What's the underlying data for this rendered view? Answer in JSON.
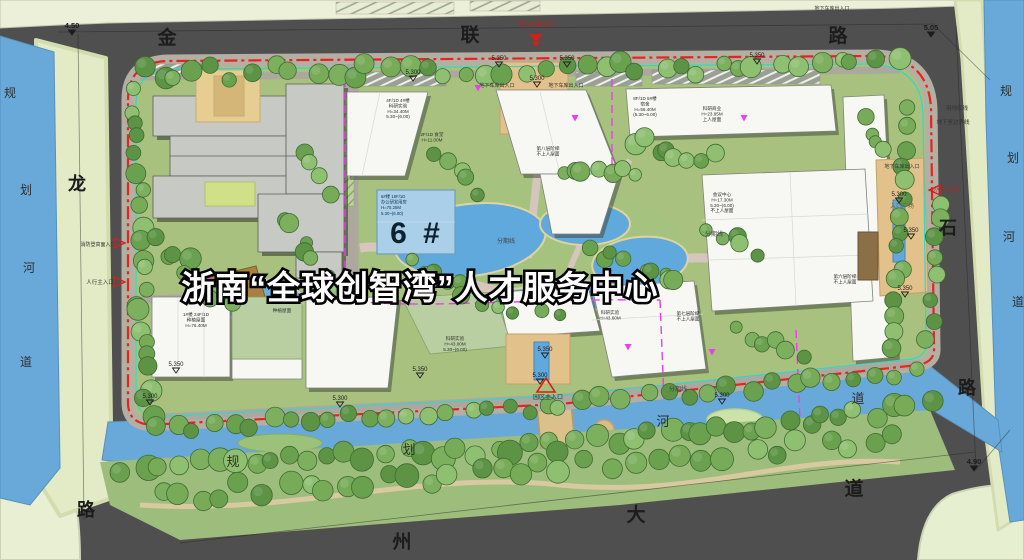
{
  "banner": {
    "title": "浙南“全球创智湾”人才服务中心"
  },
  "highlight_building": {
    "big_label": "6 #",
    "lines": [
      "6#楼 18F/1D",
      "办公研发用房",
      "H=75.25M",
      "5.30~(6.00)"
    ]
  },
  "map_labels": [
    {
      "text": "金",
      "x": 167,
      "y": 44,
      "size": 19,
      "color": "#1c1c1c",
      "bold": true
    },
    {
      "text": "联",
      "x": 470,
      "y": 41,
      "size": 19,
      "color": "#1c1c1c",
      "bold": true
    },
    {
      "text": "路",
      "x": 838,
      "y": 42,
      "size": 19,
      "color": "#1c1c1c",
      "bold": true
    },
    {
      "text": "龙",
      "x": 77,
      "y": 190,
      "size": 18,
      "color": "#1c1c1c",
      "bold": true
    },
    {
      "text": "路",
      "x": 86,
      "y": 516,
      "size": 18,
      "color": "#1c1c1c",
      "bold": true
    },
    {
      "text": "石",
      "x": 948,
      "y": 234,
      "size": 18,
      "color": "#1c1c1c",
      "bold": true
    },
    {
      "text": "路",
      "x": 967,
      "y": 394,
      "size": 18,
      "color": "#1c1c1c",
      "bold": true
    },
    {
      "text": "州",
      "x": 402,
      "y": 548,
      "size": 19,
      "color": "#1c1c1c",
      "bold": true
    },
    {
      "text": "大",
      "x": 636,
      "y": 521,
      "size": 19,
      "color": "#1c1c1c",
      "bold": true
    },
    {
      "text": "道",
      "x": 854,
      "y": 495,
      "size": 19,
      "color": "#1c1c1c",
      "bold": true
    },
    {
      "text": "规",
      "x": 10,
      "y": 97,
      "size": 12,
      "color": "#2f2f2f",
      "bold": false
    },
    {
      "text": "划",
      "x": 26,
      "y": 194,
      "size": 12,
      "color": "#2f2f2f",
      "bold": false
    },
    {
      "text": "河",
      "x": 29,
      "y": 272,
      "size": 12,
      "color": "#2f2f2f",
      "bold": false
    },
    {
      "text": "道",
      "x": 26,
      "y": 366,
      "size": 12,
      "color": "#2f2f2f",
      "bold": false
    },
    {
      "text": "规",
      "x": 1006,
      "y": 95,
      "size": 12,
      "color": "#2f2f2f",
      "bold": false
    },
    {
      "text": "划",
      "x": 1013,
      "y": 162,
      "size": 12,
      "color": "#2f2f2f",
      "bold": false
    },
    {
      "text": "河",
      "x": 1009,
      "y": 241,
      "size": 12,
      "color": "#2f2f2f",
      "bold": false
    },
    {
      "text": "道",
      "x": 1018,
      "y": 306,
      "size": 12,
      "color": "#2f2f2f",
      "bold": false
    },
    {
      "text": "规",
      "x": 233,
      "y": 466,
      "size": 13,
      "color": "#2f2f2f",
      "bold": false
    },
    {
      "text": "划",
      "x": 409,
      "y": 454,
      "size": 13,
      "color": "#2f2f2f",
      "bold": false
    },
    {
      "text": "河",
      "x": 663,
      "y": 426,
      "size": 13,
      "color": "#2f2f2f",
      "bold": false
    },
    {
      "text": "道",
      "x": 858,
      "y": 403,
      "size": 13,
      "color": "#2f2f2f",
      "bold": false
    }
  ],
  "annotations": [
    {
      "text": "办公主要入口",
      "x": 536,
      "y": 26,
      "size": 6,
      "color": "#c22015"
    },
    {
      "text": "地下车库出入口",
      "x": 497,
      "y": 87,
      "size": 5,
      "color": "#333333"
    },
    {
      "text": "地下车库出入口",
      "x": 566,
      "y": 87,
      "size": 5,
      "color": "#333333"
    },
    {
      "text": "地下车库出入口",
      "x": 832,
      "y": 10,
      "size": 5,
      "color": "#333333"
    },
    {
      "text": "地下车库出入口",
      "x": 902,
      "y": 168,
      "size": 5,
      "color": "#333333"
    },
    {
      "text": "用地红线",
      "x": 957,
      "y": 110,
      "size": 5.5,
      "color": "#333333"
    },
    {
      "text": "地下室边界线",
      "x": 953,
      "y": 124,
      "size": 5.5,
      "color": "#333333"
    },
    {
      "text": "分期线",
      "x": 506,
      "y": 243,
      "size": 6,
      "color": "#444444"
    },
    {
      "text": "分期线",
      "x": 714,
      "y": 236,
      "size": 6,
      "color": "#444444"
    },
    {
      "text": "分期线",
      "x": 678,
      "y": 391,
      "size": 6,
      "color": "#444444"
    },
    {
      "text": "入口广场",
      "x": 902,
      "y": 208,
      "size": 6,
      "color": "#7a5c28"
    },
    {
      "text": "园区主入口",
      "x": 548,
      "y": 399,
      "size": 6,
      "color": "#333333"
    },
    {
      "text": "办公主入口",
      "x": 947,
      "y": 191,
      "size": 5.5,
      "color": "#c22015"
    },
    {
      "text": "人行主入口",
      "x": 100,
      "y": 284,
      "size": 5.5,
      "color": "#333333"
    },
    {
      "text": "消防登高面入口",
      "x": 98,
      "y": 246,
      "size": 5,
      "color": "#333333"
    }
  ],
  "building_notes": [
    {
      "x": 398,
      "y": 102,
      "lines": [
        "4F/1D 4#楼",
        "科研实验",
        "H=34.40M",
        "5.30~(6.00)"
      ]
    },
    {
      "x": 432,
      "y": 136,
      "lines": [
        "2F/1D 食堂",
        "H=11.00M"
      ]
    },
    {
      "x": 645,
      "y": 100,
      "lines": [
        "8F/1D 5#楼",
        "宿舍",
        "H=56.40M",
        "(5.30~6.00)"
      ]
    },
    {
      "x": 548,
      "y": 150,
      "lines": [
        "第八层阶梯",
        "不上人屋面"
      ]
    },
    {
      "x": 712,
      "y": 110,
      "lines": [
        "科研商业",
        "H=23.95M",
        "上人屋面"
      ]
    },
    {
      "x": 722,
      "y": 196,
      "lines": [
        "会议中心",
        "H=17.30M",
        "5.30~(6.00)",
        "不上人屋面"
      ]
    },
    {
      "x": 845,
      "y": 278,
      "lines": [
        "第六层阶梯",
        "不上人屋面"
      ]
    },
    {
      "x": 688,
      "y": 315,
      "lines": [
        "第七层阶梯",
        "不上人屋面"
      ]
    },
    {
      "x": 196,
      "y": 316,
      "lines": [
        "1#楼 24F/1D",
        "种植屋面",
        "H=76.40M"
      ]
    },
    {
      "x": 282,
      "y": 312,
      "lines": [
        "种植屋面"
      ]
    },
    {
      "x": 455,
      "y": 340,
      "lines": [
        "科研实验",
        "H=43.00M",
        "5.30~(6.00)"
      ]
    },
    {
      "x": 610,
      "y": 314,
      "lines": [
        "科研实验",
        "H=43.60M"
      ]
    }
  ],
  "elevations": [
    {
      "v": "4.50",
      "x": 72,
      "y": 28,
      "style": "solid"
    },
    {
      "v": "5.05",
      "x": 931,
      "y": 30,
      "style": "solid"
    },
    {
      "v": "4.90",
      "x": 974,
      "y": 464,
      "style": "solid"
    },
    {
      "v": "5.350",
      "x": 499,
      "y": 60,
      "style": "open"
    },
    {
      "v": "5.350",
      "x": 567,
      "y": 60,
      "style": "open"
    },
    {
      "v": "5.300",
      "x": 537,
      "y": 80,
      "style": "open"
    },
    {
      "v": "5.300",
      "x": 413,
      "y": 74,
      "style": "open"
    },
    {
      "v": "5.350",
      "x": 757,
      "y": 57,
      "style": "open"
    },
    {
      "v": "5.300",
      "x": 899,
      "y": 196,
      "style": "open"
    },
    {
      "v": "5.350",
      "x": 911,
      "y": 232,
      "style": "open"
    },
    {
      "v": "5.350",
      "x": 905,
      "y": 290,
      "style": "open"
    },
    {
      "v": "5.350",
      "x": 176,
      "y": 366,
      "style": "open"
    },
    {
      "v": "5.300",
      "x": 150,
      "y": 398,
      "style": "open"
    },
    {
      "v": "5.300",
      "x": 340,
      "y": 400,
      "style": "open"
    },
    {
      "v": "5.350",
      "x": 420,
      "y": 371,
      "style": "open"
    },
    {
      "v": "5.300",
      "x": 540,
      "y": 377,
      "style": "open"
    },
    {
      "v": "5.300",
      "x": 722,
      "y": 397,
      "style": "open"
    },
    {
      "v": "5.350",
      "x": 545,
      "y": 351,
      "style": "open"
    }
  ],
  "markers": [
    {
      "type": "office-entrance",
      "x": 536,
      "y": 38
    },
    {
      "type": "main-entrance",
      "x": 546,
      "y": 386
    },
    {
      "type": "side-entrance-right",
      "x": 934,
      "y": 190
    },
    {
      "type": "side-entrance-left",
      "x": 120,
      "y": 243
    },
    {
      "type": "side-entrance-left",
      "x": 120,
      "y": 282
    },
    {
      "type": "magenta-arrow",
      "x": 478,
      "y": 88
    },
    {
      "type": "magenta-arrow",
      "x": 575,
      "y": 118
    },
    {
      "type": "magenta-arrow",
      "x": 744,
      "y": 118
    },
    {
      "type": "magenta-arrow",
      "x": 628,
      "y": 347
    },
    {
      "type": "magenta-arrow",
      "x": 208,
      "y": 281
    },
    {
      "type": "magenta-arrow",
      "x": 712,
      "y": 352
    }
  ],
  "colors": {
    "boundary_red": "#e8231f",
    "phasing_magenta": "#ee3cee",
    "setback_cyan": "#35d6c8",
    "river_blue": "#69a9d9",
    "highlight_blue": "#aacfe9",
    "road_gray": "#4f4f4f"
  }
}
